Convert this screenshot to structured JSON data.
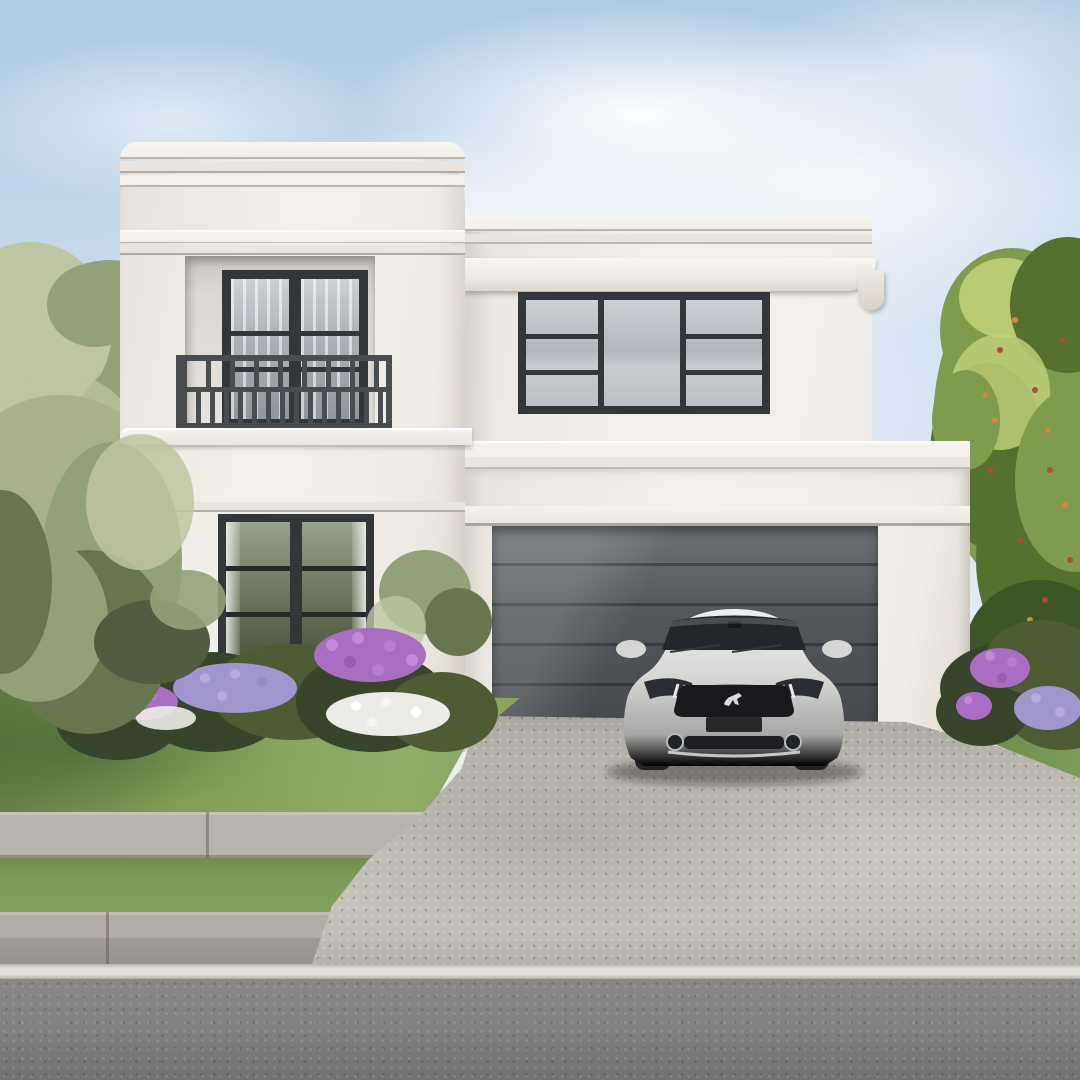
{
  "meta": {
    "domain": "natural-image",
    "description": "Photorealistic render of a white Art Deco style two-storey house with curved corners, a recessed balcony, a double garage with dark door, and a silver sports coupe parked on an exposed-aggregate driveway; green trees either side, front lawn with purple and white flowers, concrete footpath, grass verge, kerb and asphalt road in the foreground under a soft blue sky with wispy clouds."
  },
  "scene": {
    "time_of_day": "daytime, soft sunlight from upper left",
    "style": "art-deco waterfall facade, rendered exterior visualisation",
    "objects": [
      {
        "name": "sky",
        "desc": "pale blue sky with wispy white clouds"
      },
      {
        "name": "olive-tree-left",
        "desc": "sage-green olive tree overlapping the left tower"
      },
      {
        "name": "tree-right",
        "desc": "bright green tree with small red and orange accents behind the garage"
      },
      {
        "name": "house",
        "desc": "white rendered two-storey Art Deco house with rounded corners and stepped parapet bands"
      },
      {
        "name": "curved-tower",
        "desc": "rounded corner tower with triple parapet bands"
      },
      {
        "name": "balcony",
        "desc": "recessed first-floor balcony with dark French doors"
      },
      {
        "name": "balcony-railing",
        "desc": "dark geometric Art Deco metal railing"
      },
      {
        "name": "upper-window",
        "desc": "large dark-framed window, three panes, outer panes with two horizontal muntins"
      },
      {
        "name": "ground-window",
        "desc": "dark-framed two-panel window with three muntin rows reflecting garden greenery"
      },
      {
        "name": "cornice",
        "desc": "projecting white cornice band with curved right-hand return"
      },
      {
        "name": "garage-wing",
        "desc": "single-storey flat-roofed garage wing on the right"
      },
      {
        "name": "garage-door",
        "desc": "charcoal sectional garage door with horizontal seams"
      },
      {
        "name": "garden-bed",
        "desc": "shrub bed with purple, lavender and white flower clusters"
      },
      {
        "name": "hedge-flowers-right",
        "desc": "dark hedge with purple flower clusters at bottom right"
      },
      {
        "name": "lawn",
        "desc": "mown green front lawn"
      },
      {
        "name": "driveway",
        "desc": "light grey exposed-aggregate driveway with dappled tree shadows"
      },
      {
        "name": "sidewalk",
        "desc": "concrete footpath with expansion joints"
      },
      {
        "name": "verge",
        "desc": "grass nature strip between footpath and kerb"
      },
      {
        "name": "curb",
        "desc": "concrete kerb and gutter"
      },
      {
        "name": "road-line",
        "desc": "white painted edge line on the road"
      },
      {
        "name": "road",
        "desc": "grey asphalt road across the foreground"
      },
      {
        "name": "car",
        "desc": "silver sports coupe parked facing the street in front of the garage"
      }
    ],
    "car": {
      "body_style": "two-door sports coupe, front view",
      "color_name": "silver",
      "grille_badge": "running horse emblem",
      "details": [
        "dark windshield",
        "twin side mirrors",
        "LED headlight slashes",
        "black grille",
        "dark license-plate recess",
        "round fog lamps",
        "lower mesh intake"
      ]
    }
  },
  "palette": {
    "sky-top": "#afcae2",
    "sky-mid": "#cddeed",
    "sky-low": "#e7edf3",
    "wall-sun": "#f3f0eb",
    "band-face": "#f2efe9",
    "band-mid": "#e9e5de",
    "frame": "#33373a",
    "frame-deep": "#26292c",
    "glass-hi": "#ccd1d5",
    "glass": "#adb4bb",
    "glass-low": "#8d959c",
    "door-glass-hi": "#cdd1d5",
    "gglass-hi": "#97a38f",
    "gglass": "#5d6b4e",
    "gglass-low": "#3f4a38",
    "rail": "#4a4d50",
    "recess": "#d9d5cf",
    "gdoor-hi": "#6e7276",
    "gdoor": "#54585c",
    "gdoor-low": "#43474c",
    "lawn-hi": "#90ad68",
    "lawn": "#7fa058",
    "lawn-low": "#5f7a42",
    "olive-hi": "#bdc6a0",
    "olive": "#93a178",
    "olive-low": "#68764f",
    "olive-deep": "#4f5d40",
    "tree-hi": "#c2d37a",
    "tree": "#7f9c4e",
    "tree-low": "#55702f",
    "tree-deep": "#3e5525",
    "berry-red": "#b5493b",
    "berry-orange": "#d08b40",
    "shrub": "#4d5c33",
    "shrub-deep": "#37452a",
    "flower-purple": "#a96ec2",
    "flower-lav": "#a195cd",
    "flower-white": "#edebe7",
    "drive-hi": "#cac6c0",
    "drive": "#b8b4ae",
    "drive-low": "#a19d96",
    "walk": "#b7b3ac",
    "verge": "#7d9c58",
    "curb-top": "#b2aea7",
    "curb-face": "#a09c95",
    "line-white": "#e4e0d7",
    "road": "#8b8987",
    "road-deep": "#727070",
    "car-hi": "#edeeec",
    "car": "#d5d6d4",
    "car-low": "#a7a8a6",
    "car-glass": "#23272c",
    "car-dark": "#17191c"
  }
}
